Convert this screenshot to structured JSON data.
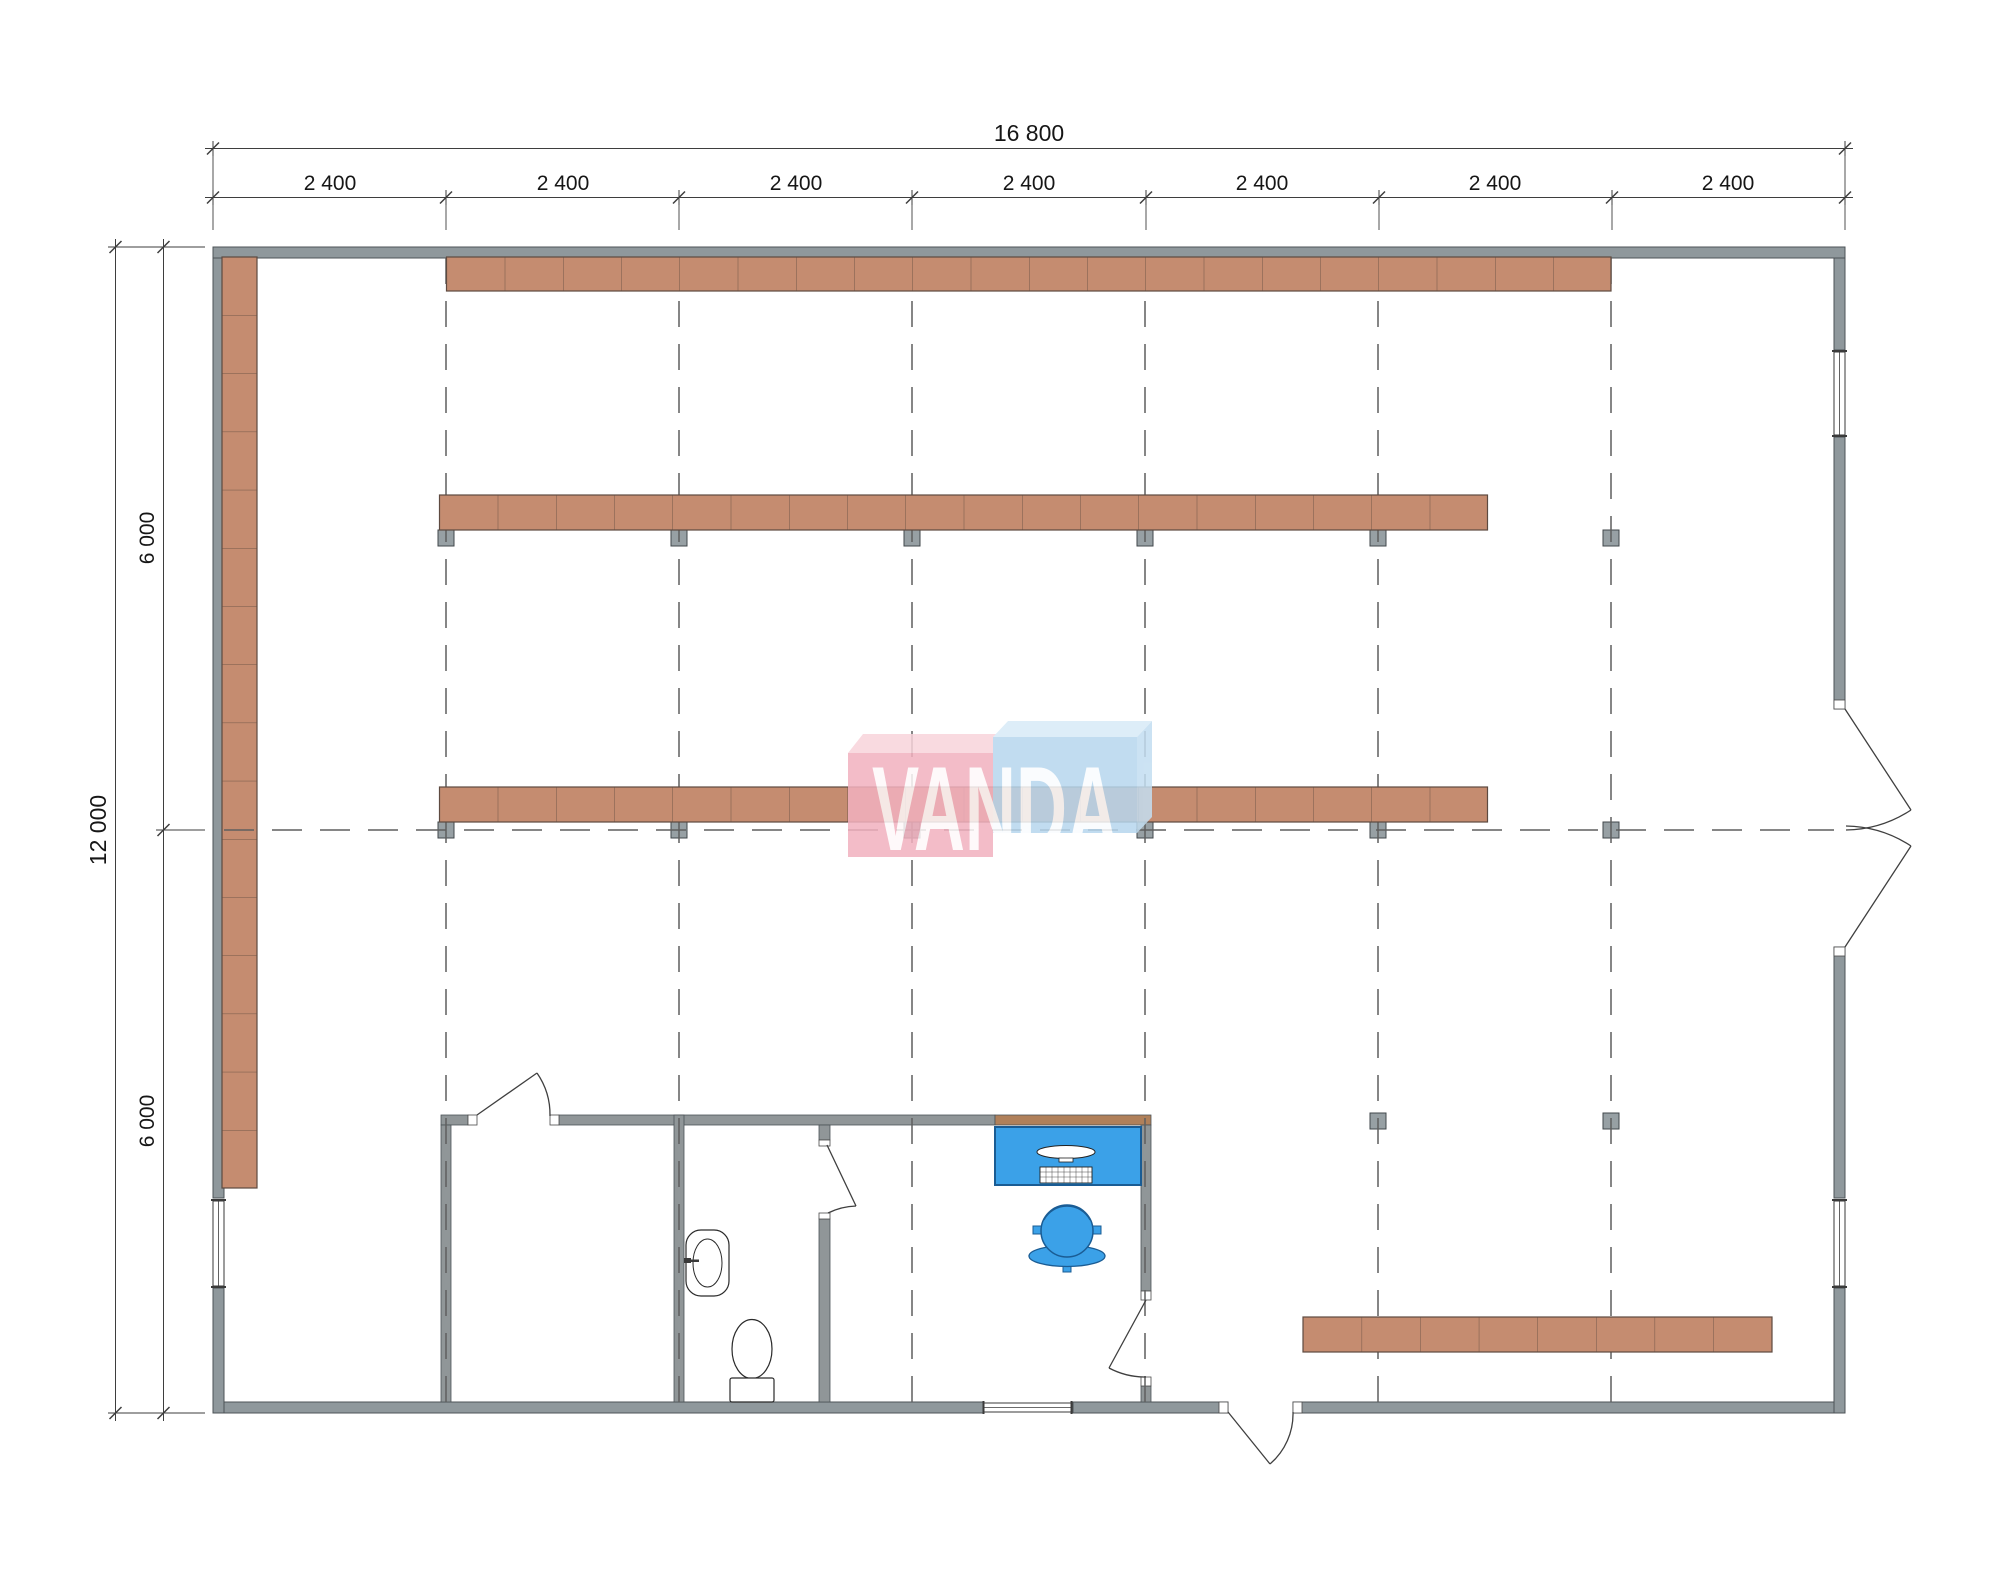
{
  "drawing": {
    "type": "architectural floor plan",
    "watermark_text": "VANDA"
  },
  "dimensions": {
    "top_total": "16 800",
    "top_bays": [
      "2 400",
      "2 400",
      "2 400",
      "2 400",
      "2 400",
      "2 400",
      "2 400"
    ],
    "left_total": "12 000",
    "left_segments": [
      "6 000",
      "6 000"
    ]
  },
  "plan": {
    "grid": {
      "x_bays": 7,
      "x_bay_label": "2 400",
      "y_segments": 2,
      "y_segment_label": "6 000",
      "total_width_label": "16 800",
      "total_height_label": "12 000"
    },
    "shelving_runs": [
      {
        "name": "top-wall-run",
        "sections": 20
      },
      {
        "name": "left-wall-run",
        "sections": 16
      },
      {
        "name": "middle-upper-run",
        "sections": 18
      },
      {
        "name": "middle-center-run",
        "sections": 18
      },
      {
        "name": "bottom-right-run",
        "sections": 8
      }
    ],
    "rooms": [
      {
        "name": "storage-room",
        "fixtures": []
      },
      {
        "name": "wc",
        "fixtures": [
          "sink",
          "toilet"
        ]
      },
      {
        "name": "office",
        "fixtures": [
          "desk",
          "monitor",
          "keyboard",
          "office-chair"
        ]
      }
    ],
    "doors": [
      "storage-room-door",
      "wc-door",
      "office-door",
      "rear-exit-door",
      "double-entrance-door"
    ],
    "windows": [
      "right-wall-window-top",
      "right-wall-window-bottom",
      "left-wall-window",
      "bottom-wall-window"
    ]
  },
  "colors": {
    "wall": "#8f989c",
    "wood_partition": "#b0805a",
    "shelf_fill": "#c58c70",
    "shelf_border": "#5d4a40",
    "column_fill": "#97a0a4",
    "column_border": "#40474b",
    "furniture_blue": "#3ba1e8",
    "furniture_blue_border": "#1a5c94",
    "grid_dash": "#5f5f5f",
    "dimension_line": "#3e3e3e",
    "logo_pink": "#f2b1bf",
    "logo_pink_top": "#f8d4db",
    "logo_blue": "#b7d7ee",
    "logo_blue_top": "#d8eaf7",
    "logo_blue_side": "#c3def1",
    "logo_text": "#ffffff"
  }
}
